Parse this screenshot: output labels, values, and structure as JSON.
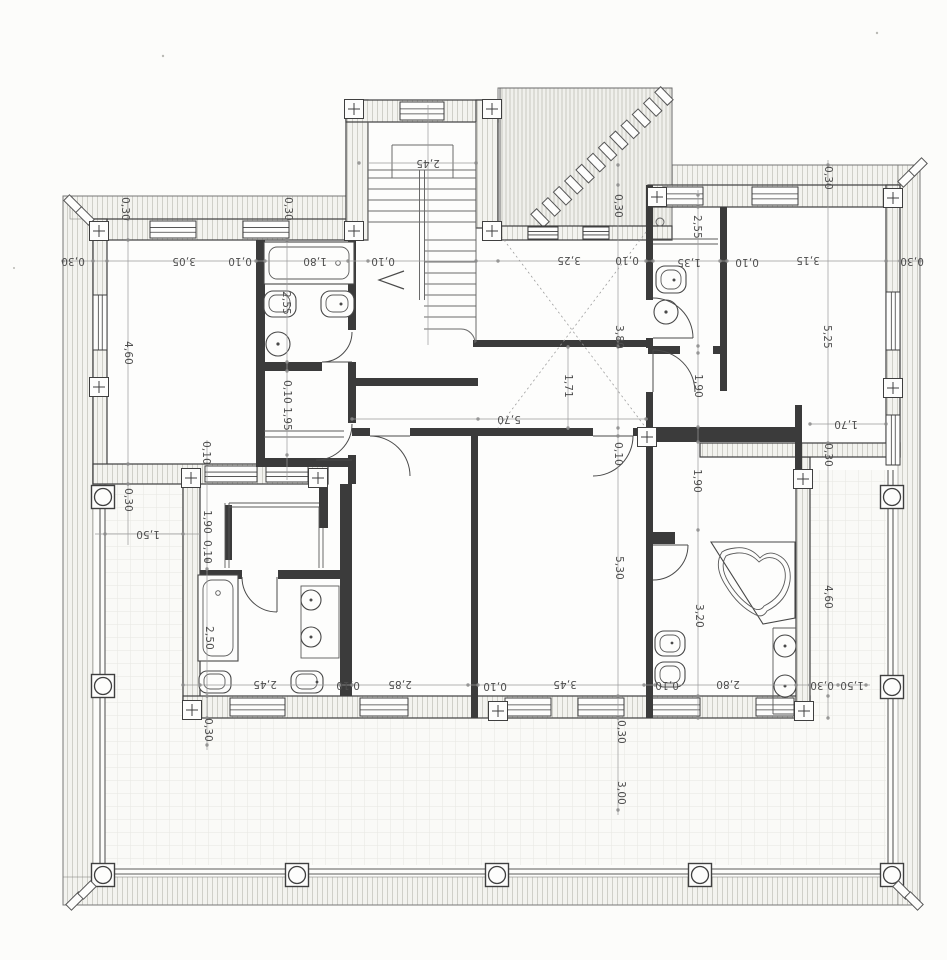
{
  "document": {
    "kind": "scanned architectural floor plan, upper storey with wrap-around terrace",
    "units": "meters (comma decimal separator)",
    "ink_color": "#3f3f3f",
    "paper_color": "#fcfcfa"
  },
  "symbols": {
    "column-icon": "circle inside square (terrace column)",
    "survey-cross-icon": "plus sign inside small square (axis marker)",
    "door-swing-icon": "quarter-circle arc with leaf line",
    "window-icon": "double-line opening in hatched wall",
    "void-cross-icon": "dashed X across open well",
    "roof-hatch-icon": "hatched area with diagonal ridge-tile band",
    "stairs-icon": "parallel treads with central stringer and direction arrow",
    "bathtub-icon": "rectangle with inset rounded basin",
    "corner-tub-icon": "corner polygon with rounded heart basin",
    "toilet-icon": "rounded rectangle pan",
    "sink-icon": "circle basin with tap dot"
  },
  "dimension_labels": [
    {
      "text": "0,30",
      "x": 125,
      "y": 209,
      "orient": "v"
    },
    {
      "text": "0,30",
      "x": 288,
      "y": 209,
      "orient": "v"
    },
    {
      "text": "0,30",
      "x": 618,
      "y": 206,
      "orient": "v"
    },
    {
      "text": "0,30",
      "x": 828,
      "y": 178,
      "orient": "v"
    },
    {
      "text": "0,30",
      "x": 73,
      "y": 261,
      "orient": "u"
    },
    {
      "text": "3,05",
      "x": 184,
      "y": 261,
      "orient": "u"
    },
    {
      "text": "0,10",
      "x": 240,
      "y": 261,
      "orient": "u"
    },
    {
      "text": "1,80",
      "x": 315,
      "y": 261,
      "orient": "u"
    },
    {
      "text": "0,10",
      "x": 383,
      "y": 261,
      "orient": "u"
    },
    {
      "text": "3,25",
      "x": 569,
      "y": 260,
      "orient": "u"
    },
    {
      "text": "0,10",
      "x": 627,
      "y": 260,
      "orient": "u"
    },
    {
      "text": "1,35",
      "x": 689,
      "y": 262,
      "orient": "u"
    },
    {
      "text": "0,10",
      "x": 747,
      "y": 262,
      "orient": "u"
    },
    {
      "text": "3,15",
      "x": 808,
      "y": 260,
      "orient": "u"
    },
    {
      "text": "0,30",
      "x": 912,
      "y": 261,
      "orient": "u"
    },
    {
      "text": "2,45",
      "x": 428,
      "y": 163,
      "orient": "u"
    },
    {
      "text": "4,60",
      "x": 128,
      "y": 353,
      "orient": "v"
    },
    {
      "text": "2,55",
      "x": 286,
      "y": 303,
      "orient": "v"
    },
    {
      "text": "0,10",
      "x": 287,
      "y": 392,
      "orient": "v"
    },
    {
      "text": "1,95",
      "x": 287,
      "y": 419,
      "orient": "v"
    },
    {
      "text": "0,30",
      "x": 128,
      "y": 500,
      "orient": "v"
    },
    {
      "text": "1,50",
      "x": 148,
      "y": 534,
      "orient": "u"
    },
    {
      "text": "0,10",
      "x": 206,
      "y": 453,
      "orient": "v"
    },
    {
      "text": "1,90",
      "x": 207,
      "y": 522,
      "orient": "v"
    },
    {
      "text": "0,10",
      "x": 207,
      "y": 552,
      "orient": "v"
    },
    {
      "text": "2,50",
      "x": 209,
      "y": 638,
      "orient": "v"
    },
    {
      "text": "2,55",
      "x": 697,
      "y": 227,
      "orient": "v"
    },
    {
      "text": "5,25",
      "x": 827,
      "y": 337,
      "orient": "v"
    },
    {
      "text": "3,80",
      "x": 619,
      "y": 337,
      "orient": "v"
    },
    {
      "text": "1,71",
      "x": 568,
      "y": 386,
      "orient": "v"
    },
    {
      "text": "5,70",
      "x": 509,
      "y": 419,
      "orient": "u"
    },
    {
      "text": "0,10",
      "x": 618,
      "y": 454,
      "orient": "v"
    },
    {
      "text": "1,90",
      "x": 698,
      "y": 386,
      "orient": "v"
    },
    {
      "text": "1,70",
      "x": 846,
      "y": 424,
      "orient": "u"
    },
    {
      "text": "0,30",
      "x": 828,
      "y": 455,
      "orient": "v"
    },
    {
      "text": "1,90",
      "x": 697,
      "y": 481,
      "orient": "v"
    },
    {
      "text": "5,30",
      "x": 619,
      "y": 568,
      "orient": "v"
    },
    {
      "text": "3,20",
      "x": 699,
      "y": 616,
      "orient": "v"
    },
    {
      "text": "4,60",
      "x": 828,
      "y": 597,
      "orient": "v"
    },
    {
      "text": "2,45",
      "x": 265,
      "y": 684,
      "orient": "u"
    },
    {
      "text": "0,10",
      "x": 348,
      "y": 685,
      "orient": "u"
    },
    {
      "text": "2,85",
      "x": 400,
      "y": 684,
      "orient": "u"
    },
    {
      "text": "0,10",
      "x": 495,
      "y": 686,
      "orient": "u"
    },
    {
      "text": "3,45",
      "x": 565,
      "y": 684,
      "orient": "u"
    },
    {
      "text": "0,10",
      "x": 667,
      "y": 685,
      "orient": "u"
    },
    {
      "text": "2,80",
      "x": 728,
      "y": 684,
      "orient": "u"
    },
    {
      "text": "0,30",
      "x": 822,
      "y": 685,
      "orient": "u"
    },
    {
      "text": "1,50",
      "x": 852,
      "y": 685,
      "orient": "u"
    },
    {
      "text": "0,30",
      "x": 208,
      "y": 730,
      "orient": "v"
    },
    {
      "text": "0,30",
      "x": 621,
      "y": 732,
      "orient": "v"
    },
    {
      "text": "3,00",
      "x": 621,
      "y": 793,
      "orient": "v"
    }
  ]
}
